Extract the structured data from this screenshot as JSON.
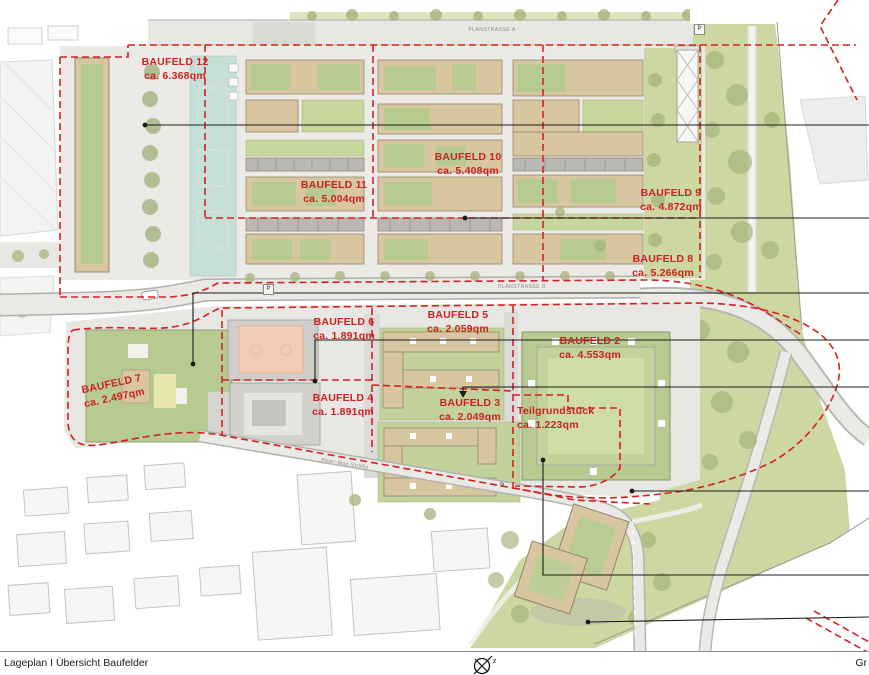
{
  "page": {
    "footer_title": "Lageplan I Übersicht Baufelder",
    "footer_right": "Gr",
    "north_arrow": "z"
  },
  "streets": {
    "planstrasse_a": "PLANSTRASSE A",
    "planstrasse_b": "PLANSTRASSE B",
    "south_street": "Peter-May-Straße",
    "parking_symbol": "P"
  },
  "baufelder": [
    {
      "name": "BAUFELD 12",
      "area": "ca. 6.368qm"
    },
    {
      "name": "BAUFELD 11",
      "area": "ca. 5.004qm"
    },
    {
      "name": "BAUFELD 10",
      "area": "ca. 5.408qm"
    },
    {
      "name": "BAUFELD 9",
      "area": "ca. 4.872qm"
    },
    {
      "name": "BAUFELD 8",
      "area": "ca. 5.266qm"
    },
    {
      "name": "BAUFELD 7",
      "area": "ca. 2.497qm"
    },
    {
      "name": "BAUFELD 6",
      "area": "ca. 1.891qm"
    },
    {
      "name": "BAUFELD 5",
      "area": "ca. 2.059qm"
    },
    {
      "name": "BAUFELD 4",
      "area": "ca. 1.891qm"
    },
    {
      "name": "BAUFELD 3",
      "area": "ca. 2.049qm"
    },
    {
      "name": "BAUFELD 2",
      "area": "ca. 4.553qm"
    },
    {
      "name": "Teilgrundstück",
      "area": "ca. 1.223qm"
    }
  ],
  "colors": {
    "boundary_red": "#d32222",
    "label_red": "#cc2121",
    "park_green": "#ccd7a1",
    "roof_green": "#b7cb90",
    "roof_tan": "#d8c6a1",
    "water_blue": "#c7dfd9",
    "road_gray": "#e8e7e4",
    "court_orange": "#f3cdb3"
  }
}
